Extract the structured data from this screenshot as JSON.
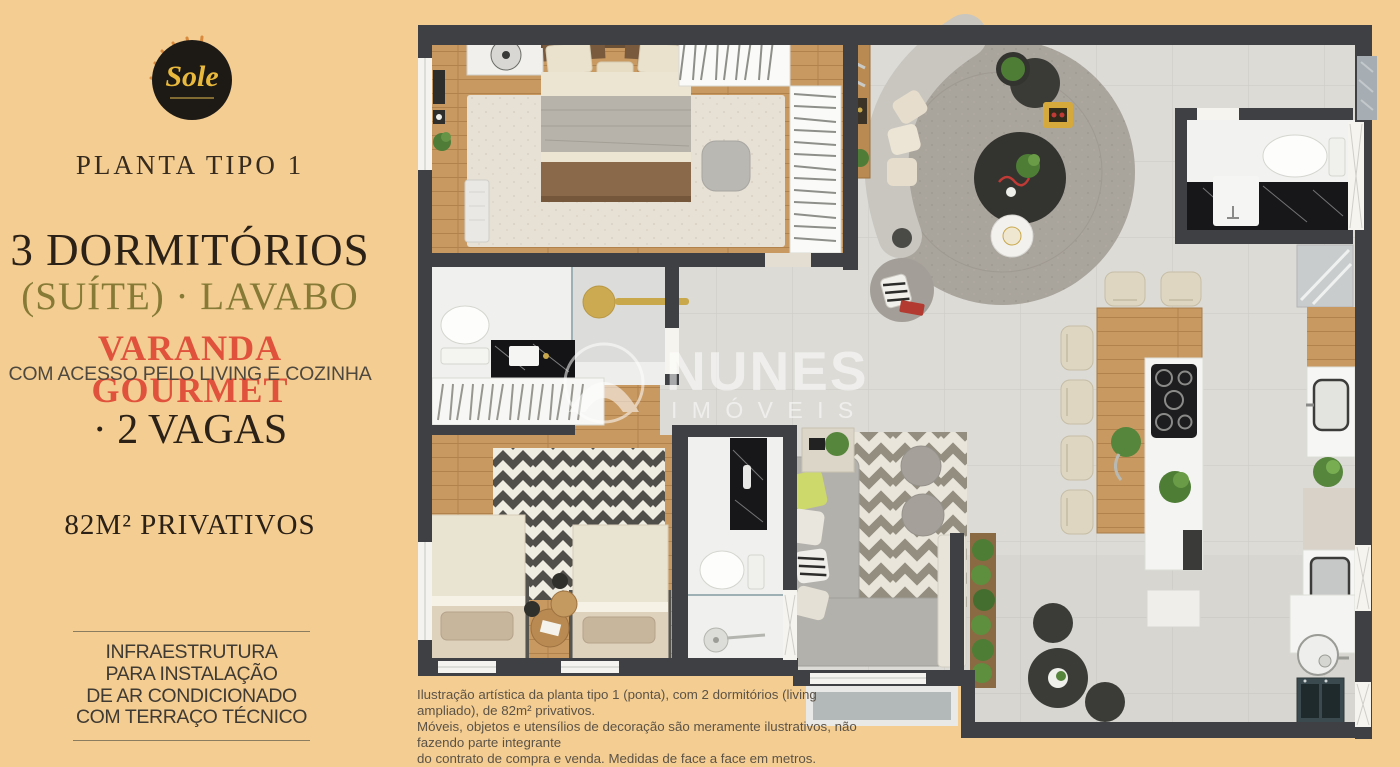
{
  "brand_panel": {
    "logo_text": "Sole",
    "plan_type_label": "PLANTA TIPO 1",
    "headline": "3 DORMITÓRIOS",
    "subheadline": "(SUÍTE) · LAVABO",
    "feature_highlight": "VARANDA GOURMET",
    "feature_detail": "COM ACESSO PELO LIVING E COZINHA",
    "parking": "· 2 VAGAS",
    "private_area": "82M² PRIVATIVOS",
    "infrastructure_note_lines": [
      "INFRAESTRUTURA",
      "PARA INSTALAÇÃO",
      "DE AR CONDICIONADO",
      "COM TERRAÇO TÉCNICO"
    ]
  },
  "floor_plan": {
    "watermark_brand": "NUNES",
    "watermark_sub": "I M Ó V E I S",
    "disclaimer_lines": [
      "Ilustração artística da planta tipo 1 (ponta), com 2 dormitórios (living ampliado), de 82m² privativos.",
      "Móveis, objetos e utensílios de decoração são meramente ilustrativos, não fazendo parte integrante",
      "do contrato de compra e venda. Medidas de face a face em metros."
    ]
  },
  "colors": {
    "background": "#f3cd92",
    "headline_text": "#2b2117",
    "subheadline_text": "#867a36",
    "highlight_text": "#e0523c",
    "body_text": "#4e483f",
    "wall": "#3f4043",
    "wood_floor": "#c89a62",
    "tile_floor": "#dcdbd6",
    "logo_gold": "#e8b93c"
  }
}
